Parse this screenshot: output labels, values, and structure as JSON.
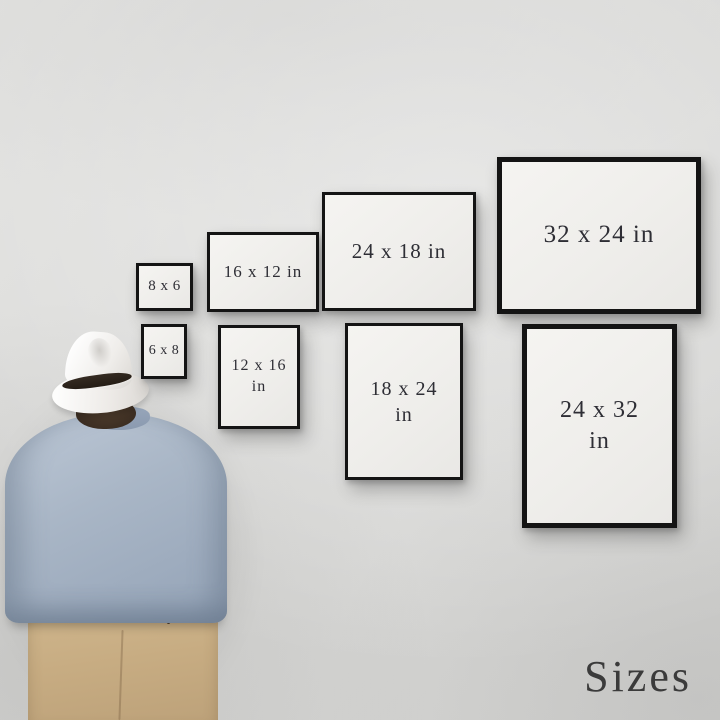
{
  "scene": {
    "kind": "wall-art-print-size-guide-mockup",
    "wall_color": "#d8d8d6"
  },
  "frames": [
    {
      "size": "8 x 6",
      "orientation": "landscape",
      "line1": "8 x 6"
    },
    {
      "size": "6 x 8",
      "orientation": "portrait",
      "line1": "6 x 8"
    },
    {
      "size": "16 x 12 in",
      "orientation": "landscape",
      "line1": "16 x 12 in"
    },
    {
      "size": "12 x 16 in",
      "orientation": "portrait",
      "line1": "12 x 16",
      "line2": "in"
    },
    {
      "size": "24 x 18 in",
      "orientation": "landscape",
      "line1": "24 x 18 in"
    },
    {
      "size": "18 x 24 in",
      "orientation": "portrait",
      "line1": "18 x 24",
      "line2": "in"
    },
    {
      "size": "32 x 24 in",
      "orientation": "landscape",
      "line1": "32 x 24 in"
    },
    {
      "size": "24 x 32 in",
      "orientation": "portrait",
      "line1": "24 x 32",
      "line2": "in"
    }
  ],
  "frame_style": {
    "border_color": "#141414",
    "mat_color": "#f2f1ee",
    "text_color": "#2e2e35"
  },
  "caption": {
    "text": "Sizes",
    "color": "#3b3b3b"
  },
  "person": {
    "description": "man viewed from behind looking at the framed prints",
    "hat_color": "#f5f3f0",
    "hat_band_color": "#2b221b",
    "hair_color": "#433326",
    "shirt_color": "#a7b4c4",
    "pants_color": "#c7ac82"
  }
}
